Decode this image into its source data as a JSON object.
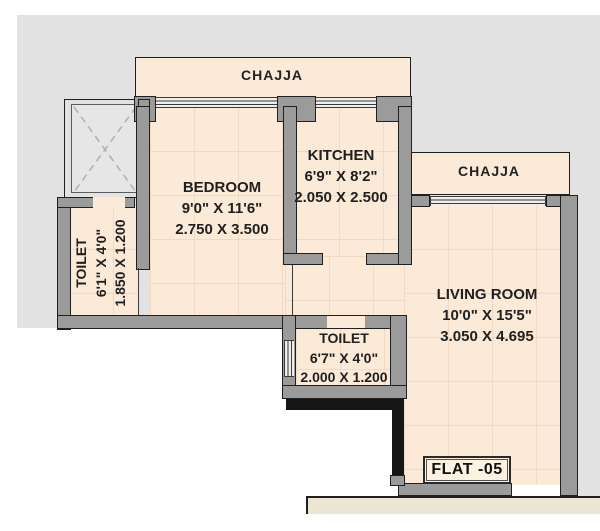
{
  "labels": {
    "chajja_top": "CHAJJA",
    "chajja_right": "CHAJJA",
    "flat": "FLAT -05"
  },
  "rooms": {
    "bedroom": {
      "name": "BEDROOM",
      "dim_ft": "9'0\" X 11'6\"",
      "dim_m": "2.750 X 3.500"
    },
    "kitchen": {
      "name": "KITCHEN",
      "dim_ft": "6'9\" X 8'2\"",
      "dim_m": "2.050 X 2.500"
    },
    "living_room": {
      "name": "LIVING ROOM",
      "dim_ft": "10'0\" X 15'5\"",
      "dim_m": "3.050 X 4.695"
    },
    "toilet_left": {
      "name": "TOILET",
      "dim_ft": "6'1\" X 4'0\"",
      "dim_m": "1.850 X 1.200"
    },
    "toilet_bottom": {
      "name": "TOILET",
      "dim_ft": "6'7\" X 4'0\"",
      "dim_m": "2.000 X 1.200"
    }
  },
  "colors": {
    "bg": "#ffffff",
    "backdrop": "#e2e2e2",
    "cream": "#fcead8",
    "grid": "#f2d9c2",
    "wall": "#9b9b9b",
    "outline": "#1f1f1f",
    "shaft": "#e6e6e6",
    "blackwall": "#161616",
    "strip": "#ebe6d4",
    "text": "#1f1f1f"
  }
}
